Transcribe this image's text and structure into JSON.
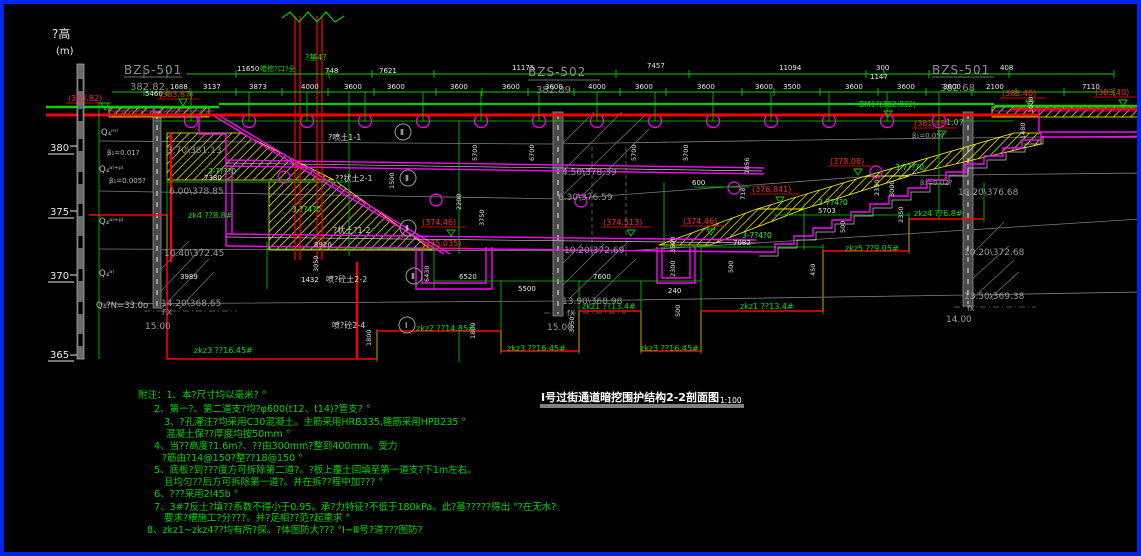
{
  "axis": {
    "title": "?高",
    "unit": "(m)",
    "t0": "380",
    "t1": "375",
    "t2": "370",
    "t3": "365"
  },
  "soil": {
    "l0": "Q₄ᵐˡ",
    "b0": "β₁=0.01?",
    "l1": "Q₄ᵃˡ⁺ᵖˡ",
    "b1": "β₁=0.005?",
    "l2": "Q₄ᵃˡ⁺ᵖˡ",
    "l3": "Q₄ᵃˡ",
    "l4": "Q₄?N=33.0o",
    "rb0": "β₁=0.05?",
    "rb1": "β₁=0.02?",
    "r107": "1.07"
  },
  "grid": {
    "g0": "BZS-501",
    "e0": "382.82",
    "g1": "BZS-502",
    "e1": "382.89",
    "g2": "BZS-501",
    "e2": "382.68"
  },
  "dim1": [
    "11650",
    "748",
    "7621",
    "11175",
    "7457",
    "11094",
    "300",
    "1147",
    "408"
  ],
  "dim2": [
    "5460",
    "1688",
    "3137",
    "3873",
    "4000",
    "3600",
    "3600",
    "3600",
    "3600",
    "3600",
    "4000",
    "3600",
    "3600",
    "3600",
    "3500",
    "3600",
    "3600",
    "3600",
    "2100",
    "7110"
  ],
  "dimh": [
    "7380",
    "8920",
    "6520",
    "5500",
    "7600",
    "240",
    "7082",
    "5703",
    "600",
    "1432",
    "3989"
  ],
  "dimv": [
    "5700",
    "6700",
    "5700",
    "5700",
    "2200",
    "3750",
    "1500",
    "1856",
    "718",
    "2350",
    "3000",
    "2350",
    "3500",
    "2300",
    "3050",
    "6430",
    "1800",
    "1800",
    "3050",
    "500",
    "500",
    "450",
    "500",
    "1480",
    "1000"
  ],
  "lev": [
    "3.70\\381.13",
    "6.00\\378.85",
    "10.40\\372.45",
    "14.20\\368.65",
    "4.50\\378.39",
    "6.30\\376.59",
    "10.20\\372.69",
    "13.90\\368.98",
    "10.20\\376.68",
    "10.20\\372.68",
    "13.50\\369.38"
  ],
  "depth": {
    "d0": "15.00",
    "f0": "FX",
    "d1": "15.00",
    "f1": "fX",
    "d2": "14.00",
    "f2": "fx"
  },
  "red": [
    "(383.82)",
    "(383.87)",
    "(374.46)",
    "(375.035)",
    "(374.513)",
    "(374.46)",
    "(376.841)",
    "(378.08)",
    "(381.48)",
    "(383.40)",
    "(383.40)"
  ],
  "bh": [
    "zk4 ??8.8#",
    "zkz3 ??16.45#",
    "zkz2 ??14.85#",
    "zkz3 ??16.45#",
    "zkz1 ??13.4#",
    "zkz3 ??16.45#",
    "zkz1 ??13.4#",
    "zkz5 ??9.05#",
    "zkz4 ??6.8#"
  ],
  "wl": [
    "3-????0",
    "3-??4?0",
    "3-7?4?0",
    "3-7?4?0",
    "3-7???0"
  ],
  "sl": [
    "?喷土1-1",
    "??状土2-1",
    "?状土?1-2",
    "喷?砼土2-2",
    "喷?砼2-4"
  ],
  "mk": {
    "m0": "Ⅱ",
    "m1": "Ⅱ",
    "m2": "Ⅱ",
    "m3": "Ⅱ",
    "m4": "Ⅰ"
  },
  "gn": {
    "portal": "暗挖?口?全",
    "pile": "?基4?",
    "bm": "BM1?(382.832)"
  },
  "notes": {
    "n0": "附注：1、本?尺寸均以毫米? °",
    "n1": "2、第一?、第二道支?均?φ600(t12、t14)?管支? °",
    "n2": "3、?孔灌注?均采用C30混凝土。主筋采用HRB335,箍筋采用HPB235 °",
    "n3": "混凝土保??厚度均按50mm °",
    "n4": "4、当??高度?1.6m?、??由300mm?整到400mm。受力",
    "n5": "?筋由?14@150?整??18@150 °",
    "n6": "5、底板?到???度方可拆除第二道?。?板上覆土回填至第一道支?下1m左右。",
    "n7": "且均匀??后方可拆除第一道?。并在拆??程中加??? °",
    "n8": "6、???采用2I45b °",
    "n9": "7、3#7反土?填??系数不得小于0.95。承?力特征?不低于180kPa。此?基?????得出 °?在无水?",
    "n10": "要求?槽施工?分???。并?足相??范?起重求 °",
    "n11": "8、zkz1~zkz4??均有所?探。?体图防大??? °Ⅰ~Ⅲ号?道???图防?"
  },
  "title": {
    "text": "Ⅰ号过街通道暗挖围护结构2-2剖面图",
    "scale": "1:100"
  }
}
